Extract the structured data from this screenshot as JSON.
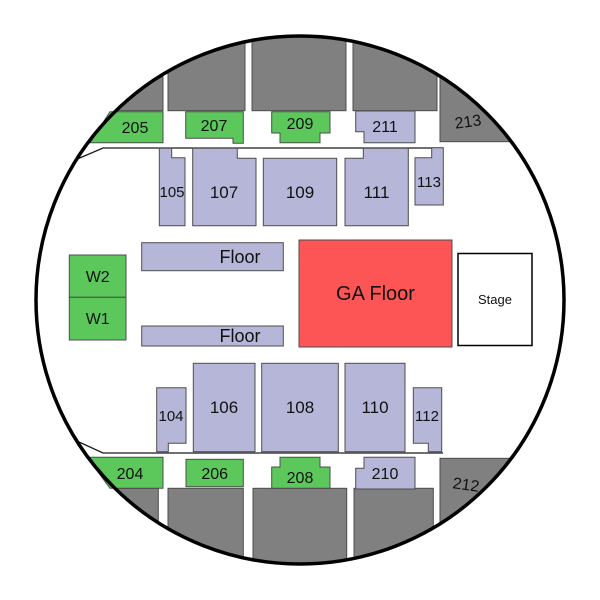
{
  "palette": {
    "green": "#5cc85c",
    "lavender": "#b6b6d9",
    "red": "#fd5555",
    "gray": "#808080",
    "white": "#ffffff",
    "outline": "#000000"
  },
  "sections": {
    "205": {
      "label": "205"
    },
    "207": {
      "label": "207"
    },
    "209": {
      "label": "209"
    },
    "211": {
      "label": "211"
    },
    "213": {
      "label": "213"
    },
    "105": {
      "label": "105"
    },
    "107": {
      "label": "107"
    },
    "109": {
      "label": "109"
    },
    "111": {
      "label": "111"
    },
    "113": {
      "label": "113"
    },
    "104": {
      "label": "104"
    },
    "106": {
      "label": "106"
    },
    "108": {
      "label": "108"
    },
    "110": {
      "label": "110"
    },
    "112": {
      "label": "112"
    },
    "204": {
      "label": "204"
    },
    "206": {
      "label": "206"
    },
    "208": {
      "label": "208"
    },
    "210": {
      "label": "210"
    },
    "212": {
      "label": "212"
    },
    "W1": {
      "label": "W1"
    },
    "W2": {
      "label": "W2"
    }
  },
  "floor": {
    "ga": "GA Floor",
    "stage": "Stage",
    "floor_top": "Floor",
    "floor_bottom": "Floor"
  }
}
